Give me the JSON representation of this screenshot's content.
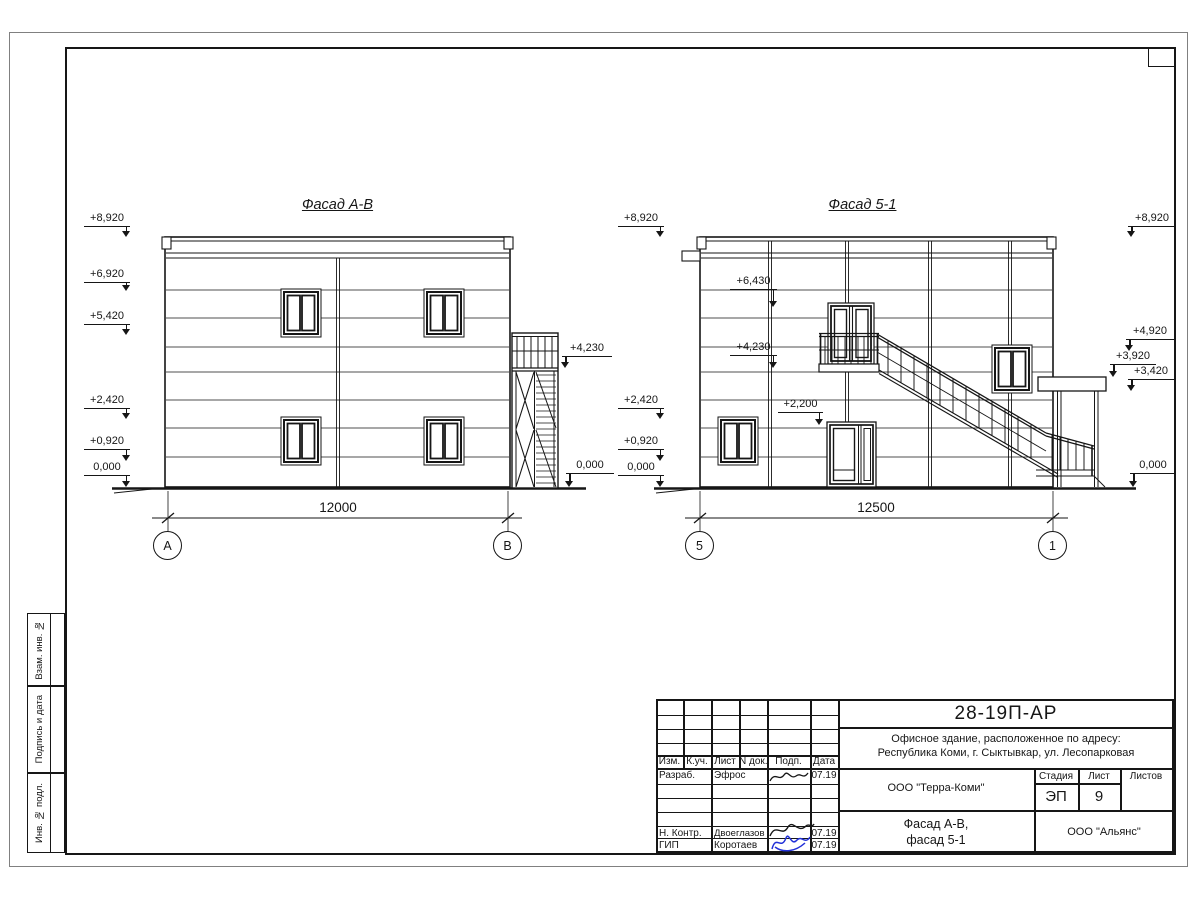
{
  "colors": {
    "line_color": "#161616",
    "signature_blue": "#2231d8"
  },
  "sheet": {
    "side_strip": [
      {
        "label": "Взам. инв. №"
      },
      {
        "label": "Подпись и дата"
      },
      {
        "label": "Инв. № подл."
      }
    ],
    "title_block": {
      "doc_number": "28-19П-АР",
      "project_address_line1": "Офисное здание, расположенное по адресу:",
      "project_address_line2": "Республика Коми, г. Сыктывкар, ул. Лесопарковая",
      "table_headers": [
        "Изм.",
        "К.уч.",
        "Лист",
        "N док.",
        "Подп.",
        "Дата"
      ],
      "rows": [
        {
          "role": "Разраб.",
          "name": "Эфрос",
          "date": "07.19"
        },
        {
          "role": "Н. Контр.",
          "name": "Двоеглазов",
          "date": "07.19"
        },
        {
          "role": "ГИП",
          "name": "Коротаев",
          "date": "07.19"
        }
      ],
      "designer_company": "ООО \"Терра-Коми\"",
      "stage_label": "Стадия",
      "sheet_label": "Лист",
      "sheets_label": "Листов",
      "stage_value": "ЭП",
      "sheet_value": "9",
      "drawing_title_line1": "Фасад А-В,",
      "drawing_title_line2": "фасад 5-1",
      "contractor_company": "ООО \"Альянс\""
    }
  },
  "facade_ab": {
    "title": "Фасад А-В",
    "dimension": "12000",
    "axis_left": "А",
    "axis_right": "В",
    "marks_left": [
      "+8,920",
      "+6,920",
      "+5,420",
      "+2,420",
      "+0,920",
      "0,000"
    ],
    "marks_right": [
      "+4,230",
      "0,000"
    ]
  },
  "facade_51": {
    "title": "Фасад 5-1",
    "dimension": "12500",
    "axis_left": "5",
    "axis_right": "1",
    "marks_left": [
      "+8,920",
      "+2,420",
      "+0,920",
      "0,000"
    ],
    "marks_inner": [
      "+6,430",
      "+4,230",
      "+2,200"
    ],
    "marks_right": [
      "+8,920",
      "+4,920",
      "+3,920",
      "+3,420",
      "0,000"
    ]
  }
}
